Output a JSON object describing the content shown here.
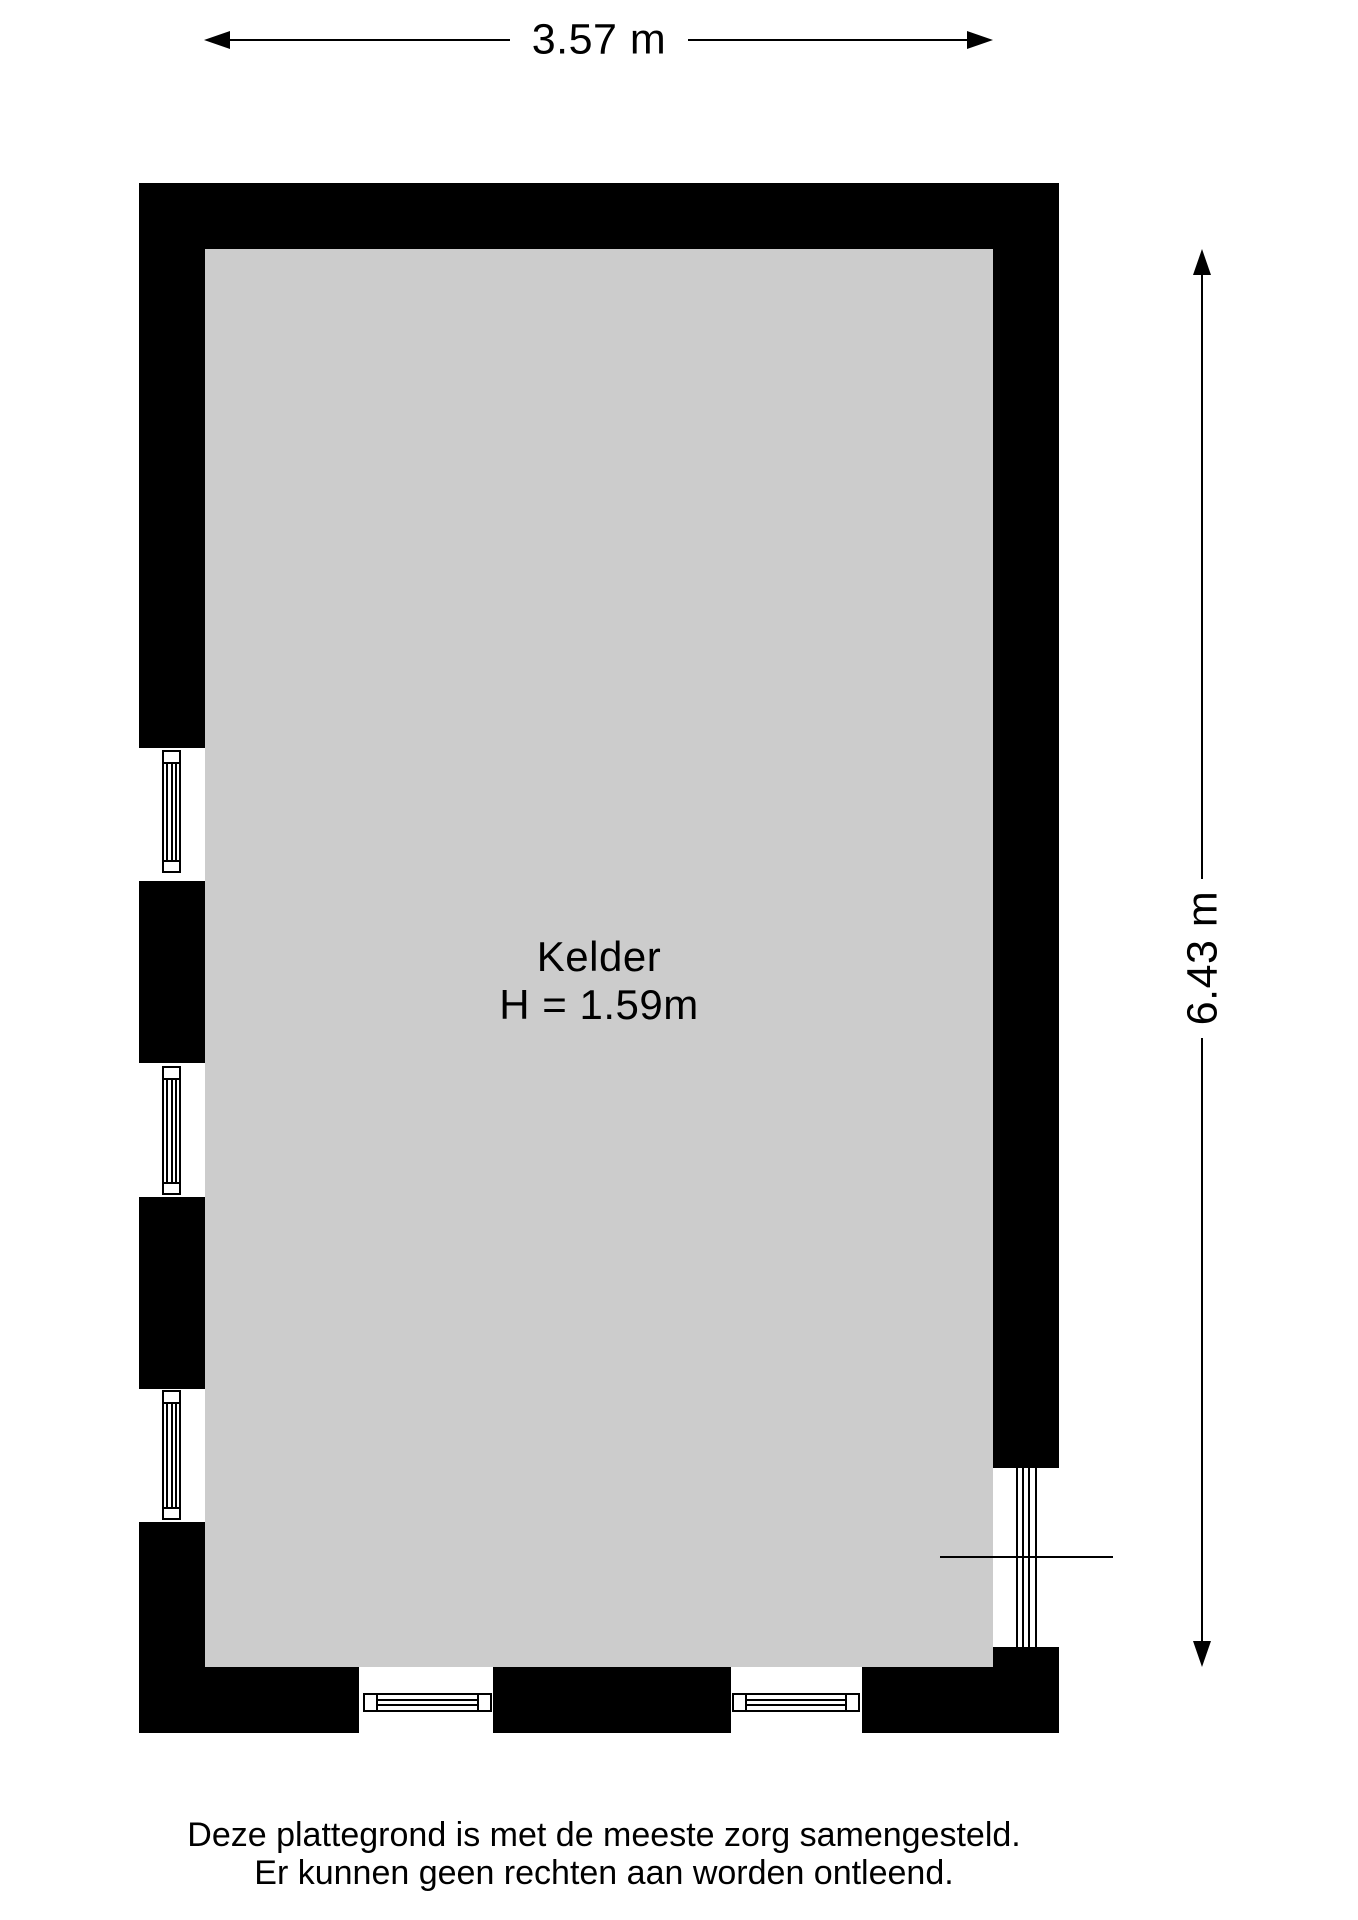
{
  "room": {
    "name": "Kelder",
    "height_label": "H = 1.59m"
  },
  "dimensions": {
    "width_label": "3.57 m",
    "height_label": "6.43 m"
  },
  "disclaimer": {
    "line1": "Deze plattegrond is met de meeste zorg samengesteld.",
    "line2": "Er kunnen geen rechten aan worden ontleend."
  },
  "colors": {
    "wall": "#000000",
    "floor": "#cccccc",
    "background": "#ffffff",
    "text": "#000000"
  }
}
